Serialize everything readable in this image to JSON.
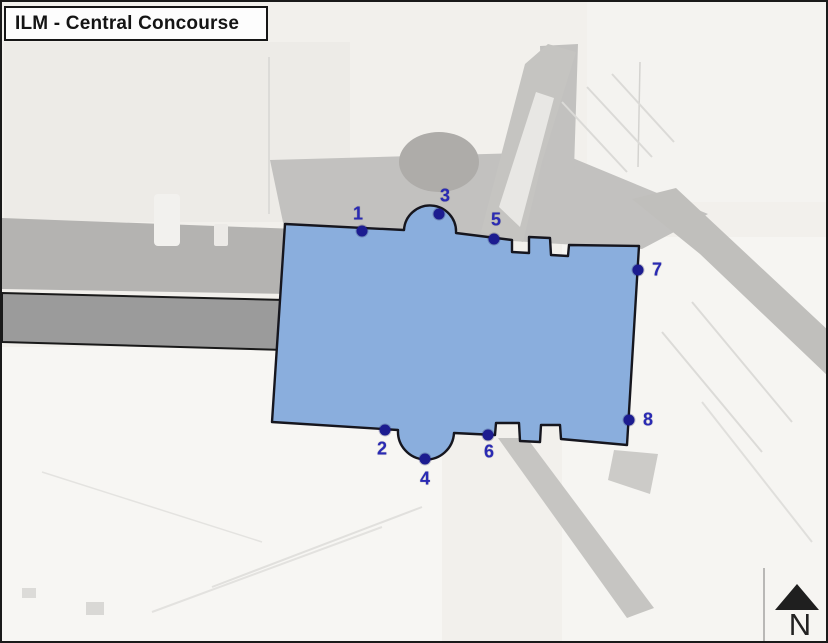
{
  "title": "ILM - Central Concourse",
  "compass": {
    "label": "N"
  },
  "map": {
    "concourse_fill": "#8aaedd",
    "concourse_outline": "#16161e",
    "gate_dot_color": "#1c1c90",
    "gate_number_color": "#2a2ab4",
    "gates": [
      {
        "label": "1",
        "dot_x": 360,
        "dot_y": 229,
        "label_x": 356,
        "label_y": 212
      },
      {
        "label": "2",
        "dot_x": 383,
        "dot_y": 428,
        "label_x": 380,
        "label_y": 447
      },
      {
        "label": "3",
        "dot_x": 437,
        "dot_y": 212,
        "label_x": 443,
        "label_y": 194
      },
      {
        "label": "4",
        "dot_x": 423,
        "dot_y": 457,
        "label_x": 423,
        "label_y": 477
      },
      {
        "label": "5",
        "dot_x": 492,
        "dot_y": 237,
        "label_x": 494,
        "label_y": 218
      },
      {
        "label": "6",
        "dot_x": 486,
        "dot_y": 433,
        "label_x": 487,
        "label_y": 450
      },
      {
        "label": "7",
        "dot_x": 636,
        "dot_y": 268,
        "label_x": 655,
        "label_y": 268
      },
      {
        "label": "8",
        "dot_x": 627,
        "dot_y": 418,
        "label_x": 646,
        "label_y": 418
      }
    ]
  }
}
